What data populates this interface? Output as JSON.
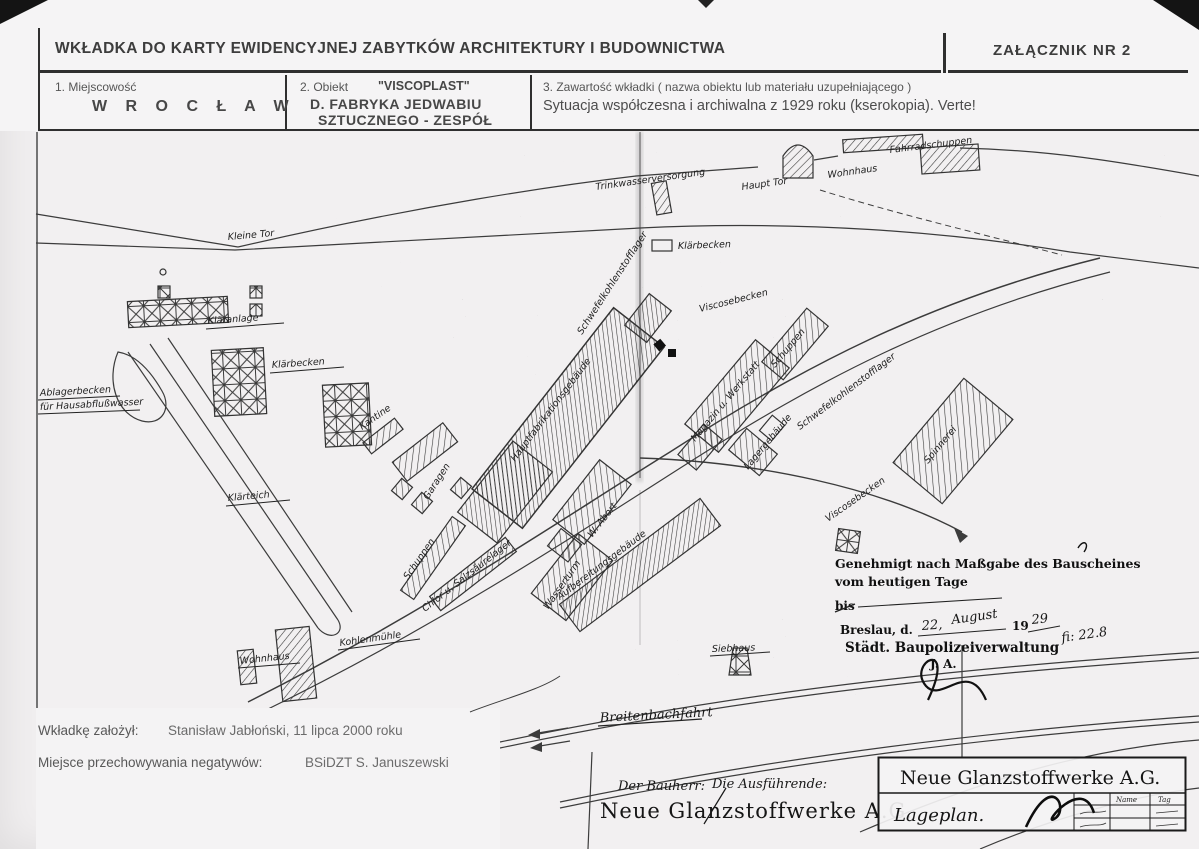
{
  "page": {
    "header": {
      "title": "WKŁADKA DO KARTY EWIDENCYJNEJ ZABYTKÓW ARCHITEKTURY I BUDOWNICTWA",
      "attachment": "ZAŁĄCZNIK NR 2"
    },
    "fields": {
      "f1_label": "1. Miejscowość",
      "f1_value": "W R O C Ł A W",
      "f2_label": "2. Obiekt",
      "f2_quote": "\"VISCOPLAST\"",
      "f2_value_line1": "D. FABRYKA JEDWABIU",
      "f2_value_line2": "SZTUCZNEGO - ZESPÓŁ",
      "f3_label": "3. Zawartość wkładki ( nazwa obiektu lub materiału uzupełniającego )",
      "f3_value": "Sytuacja współczesna i archiwalna z 1929 roku (kserokopia). Verte!"
    },
    "footer": {
      "founder_label": "Wkładkę założył:",
      "founder_value": "Stanisław Jabłoński, 11 lipca 2000 roku",
      "negatives_label": "Miejsce przechowywania negatywów:",
      "negatives_value": "BSiDZT S. Januszewski"
    }
  },
  "map": {
    "labels": {
      "trinkwasser": "Trinkwasserversorgung",
      "haupttor": "Haupt Tor",
      "wohnhaus_top": "Wohnhaus",
      "fahrradschuppen": "Fahrradschuppen",
      "kleinetor": "Kleine Tor",
      "klaerbecken_small": "Klärbecken",
      "viscosebecken_top": "Viscosebecken",
      "cs2_lager_left": "Schwefelkohlenstofflager",
      "klaeranlage": "Kläranlage",
      "klaerbecken_left": "Klärbecken",
      "ablagerbecken_1": "Ablagerbecken",
      "ablagerbecken_2": "für Hausabflußwasser",
      "klaerteich": "Klärteich",
      "kantine": "Kantine",
      "garagen": "Garagen",
      "hauptfabrik": "Hauptfabrikationsgebäude",
      "magazin": "Magazin u. Werkstatt",
      "schuppen_top": "Schuppen",
      "cs2_lager_right": "Schwefelkohlenstofflager",
      "spinnerei": "Spinnerei",
      "lagergebaeude": "Lagergebäude",
      "wabort": "W. Abort",
      "aufbereitung": "Aufbereitungsgebäude",
      "viscosebecken_right": "Viscosebecken",
      "chlorlager": "Chlor u. Salzsäurelager",
      "wasserturm": "Wasserturm",
      "schuppen_low": "Schuppen",
      "wohnhaus_bottom": "Wohnhaus",
      "kohlenmuehle": "Kohlenmühle",
      "siebhaus": "Siebhaus",
      "breitenbach": "Breitenbachfahrt"
    },
    "stamp": {
      "approval_1": "Genehmigt nach Maßgabe des Bauscheines",
      "approval_2": "vom heutigen Tage",
      "bis": "bis",
      "city": "Breslau, d.",
      "day": "22,",
      "month": "August",
      "year_pre": "19",
      "year": "29",
      "authority": "Städt. Baupolizeiverwaltung",
      "initials": "J. A.",
      "note": "fi: 22.8"
    },
    "bauherr": {
      "label_left": "Der Bauherr:",
      "label_right": "Die Ausführende:",
      "company": "Neue Glanzstoffwerke A.G."
    },
    "titleblock": {
      "company": "Neue Glanzstoffwerke A.G.",
      "title": "Lageplan.",
      "col_name": "Name",
      "col_tag": "Tag"
    },
    "colors": {
      "paper": "#f2f0f1",
      "ink": "#3a3a3a"
    }
  }
}
